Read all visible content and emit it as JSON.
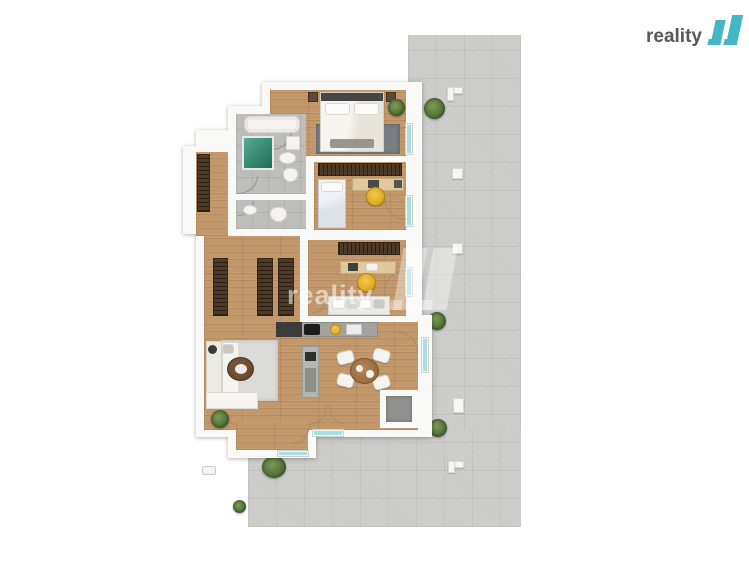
{
  "brand": {
    "logo_text": "reality",
    "logo_mark": "11",
    "logo_text_color": "#58585a",
    "logo_mark_color": "#45b6c6"
  },
  "watermark": {
    "text": "reality",
    "mark": "11"
  },
  "palette": {
    "background": "#ffffff",
    "terrace_concrete": "#cbcbc9",
    "wall_white": "#f9f9f7",
    "wood_floor": "#c2976a",
    "bathroom_tile": "#bdbdbb",
    "wardrobe_wood": "#4e3a27",
    "accent_chair_yellow": "#dca61e",
    "shower_teal": "#2f8f78",
    "glass_teal": "#a7e0e2",
    "bedroom_rug": "#787e84",
    "living_rug": "#dadad6",
    "plant_green": "#4a6a33"
  },
  "scene": {
    "type": "apartment-floor-plan-top-view",
    "rooms": [
      "bedroom",
      "bathroom",
      "wc",
      "corridor",
      "hallway",
      "kids-room",
      "study",
      "open-living-room-kitchen",
      "entry",
      "terrace",
      "storage"
    ],
    "furniture_icons": [
      "double-bed-icon",
      "nightstand-icon",
      "bathtub-icon",
      "shower-icon",
      "washbasin-icon",
      "toilet-icon",
      "washing-machine-icon",
      "wardrobe-icon",
      "single-bed-icon",
      "desk-icon",
      "desk-chair-icon",
      "daybed-sofa-icon",
      "kitchen-counter-icon",
      "cooktop-icon",
      "sink-icon",
      "kitchen-island-icon",
      "dining-table-icon",
      "dining-chair-icon",
      "corner-sofa-icon",
      "coffee-table-icon",
      "floor-lamp-icon",
      "rug-icon",
      "plant-icon",
      "door-swing-arc-icon",
      "glass-door-icon",
      "terrace-column-icon",
      "ac-unit-icon"
    ]
  }
}
